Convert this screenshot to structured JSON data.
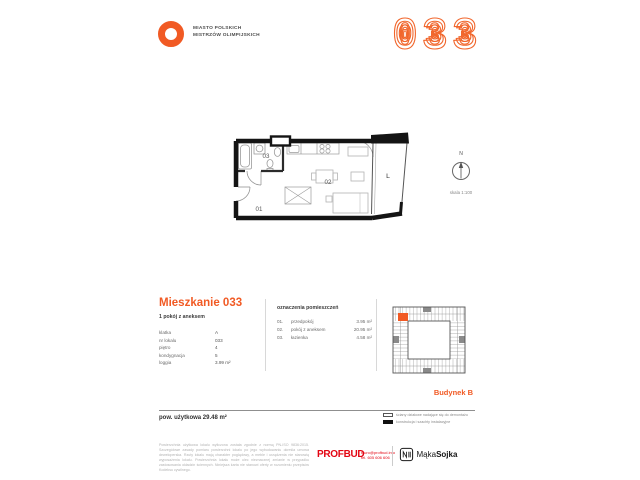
{
  "colors": {
    "accent_orange": "#F15A24",
    "developer_red": "#E30613"
  },
  "header": {
    "brand_line1": "MIASTO POLSKICH",
    "brand_line2": "MISTRZÓW OLIMPIJSKICH",
    "unit_number": "033",
    "unit_digits": [
      "0",
      "3",
      "3"
    ]
  },
  "plan": {
    "labels": {
      "hall": "01",
      "room": "02",
      "bath": "03",
      "loggia": "L"
    },
    "compass": "N",
    "scale": "skala 1:100"
  },
  "details": {
    "title": "Mieszkanie 033",
    "subtitle": "1 pokój z aneksem",
    "rows": [
      {
        "label": "klatka",
        "value": "A"
      },
      {
        "label": "nr lokalu",
        "value": "033"
      },
      {
        "label": "piętro",
        "value": "4"
      },
      {
        "label": "kondygnacja",
        "value": "5"
      },
      {
        "label": "loggia",
        "value": "3.99 m²"
      }
    ]
  },
  "rooms": {
    "title": "oznaczenia pomieszczeń",
    "rows": [
      {
        "no": "01.",
        "name": "przedpokój",
        "area": "3.95 m²"
      },
      {
        "no": "02.",
        "name": "pokój z aneksem",
        "area": "20.95 m²"
      },
      {
        "no": "03.",
        "name": "łazienka",
        "area": "4.58 m²"
      }
    ]
  },
  "building": {
    "label": "Budynek B"
  },
  "summary": {
    "usable_area": "pow. użytkowa 29.48 m²"
  },
  "legend": {
    "items": [
      {
        "label": "ściany działowe nadające się do demontażu"
      },
      {
        "label": "konstrukcja i szachty instalacyjne"
      }
    ]
  },
  "footer": {
    "disclaimer": "Powierzchnia użytkowa lokalu wyliczona została zgodnie z normą PN-ISO 9836:2015. Szczegółowe zasady pomiaru powierzchni lokalu po jego wybudowaniu określa umowa deweloperska. Rzuty lokalu mają charakter poglądowy, a meble i urządzenia nie stanowią wyposażenia lokalu. Powierzchnia lokalu może ulec nieznacznej zmianie w przypadku zastosowania okładzin ściennych. Niniejsza karta nie stanowi oferty w rozumieniu przepisów Kodeksu cywilnego.",
    "developer": "PROFBUD",
    "email": "biuro@profbud.info",
    "phone": "tel. 605 606 606",
    "architect_part1": "Mąka",
    "architect_part2": "Sojka"
  }
}
